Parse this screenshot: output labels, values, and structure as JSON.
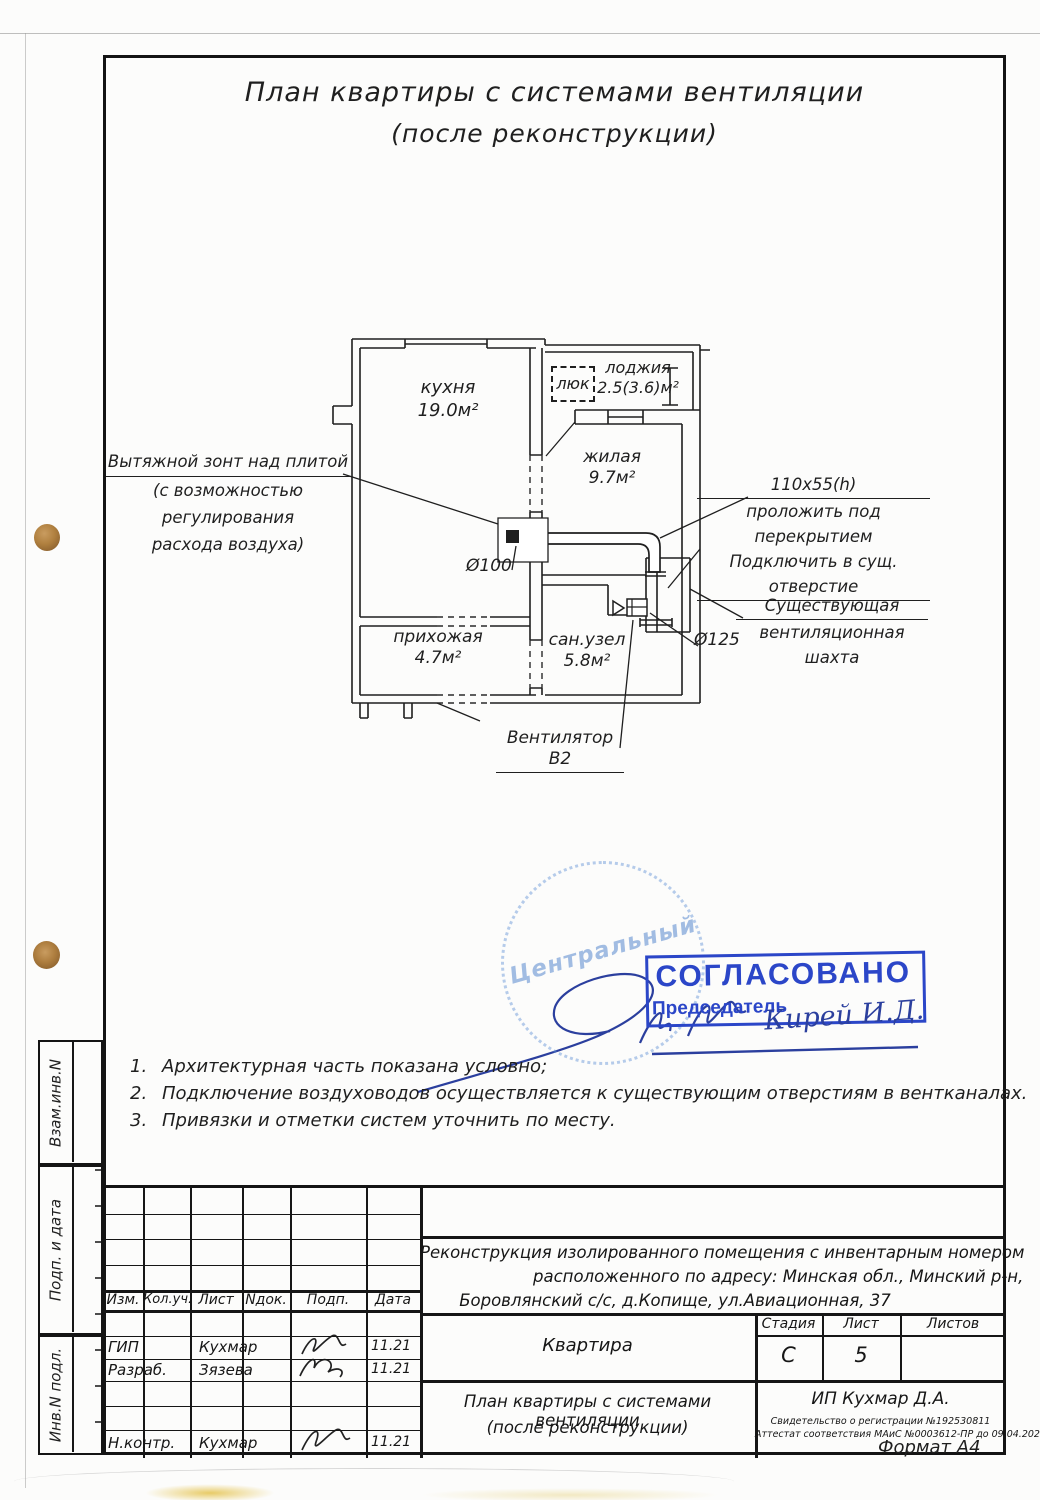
{
  "title": {
    "line1": "План квартиры с системами вентиляции",
    "line2": "(после реконструкции)"
  },
  "plan": {
    "rooms": [
      {
        "name": "кухня",
        "area": "19.0м²"
      },
      {
        "name": "лоджия",
        "area": "2.5(3.6)м²"
      },
      {
        "name": "жилая",
        "area": "9.7м²"
      },
      {
        "name": "прихожая",
        "area": "4.7м²"
      },
      {
        "name": "сан.узел",
        "area": "5.8м²"
      }
    ],
    "hatch_label": "люк",
    "d100": "Ø100",
    "d125": "Ø125",
    "fan_label": "Вентилятор В2",
    "duct_size": "110x55(h)",
    "duct_note1": "проложить под перекрытием",
    "duct_note2": "Подключить в сущ. отверстие",
    "shaft_line1": "Существующая",
    "shaft_line2": "вентиляционная шахта",
    "hood_line1": "Вытяжной зонт над плитой",
    "hood_line2": "(с возможностью регулирования",
    "hood_line3": "расхода воздуха)"
  },
  "notes": [
    {
      "num": "1.",
      "text": "Архитектурная часть показана условно;"
    },
    {
      "num": "2.",
      "text": "Подключение воздуховодов осуществляется к существующим отверстиям в вентканалах."
    },
    {
      "num": "3.",
      "text": "Привязки и отметки систем уточнить по месту."
    }
  ],
  "stamps": {
    "round_text": "Центральный",
    "approved": "СОГЛАСОВАНО",
    "chairman": "Председатель",
    "signature": "Кирей И.Д.",
    "stamp_blue": "#2b46c8",
    "signature_blue": "#2b3f9e"
  },
  "sidebar": {
    "box1": "Взам.инв.N",
    "box2": "Подп. и дата",
    "box3": "Инв.N подл."
  },
  "titleblock": {
    "col_izm": "Изм.",
    "col_kol": "Кол.уч.",
    "col_list": "Лист",
    "col_ndok": "Nдок.",
    "col_podp": "Подп.",
    "col_data": "Дата",
    "rows": [
      {
        "role": "ГИП",
        "name": "Кухмар",
        "date": "11.21"
      },
      {
        "role": "Разраб.",
        "name": "Зязева",
        "date": "11.21"
      },
      {
        "role": "Н.контр.",
        "name": "Кухмар",
        "date": "11.21"
      }
    ],
    "project_line1": "Реконструкция изолированного помещения с инвентарным номером",
    "project_line2": "расположенного по адресу: Минская обл., Минский р-н,",
    "project_line3": "Боровлянский с/с, д.Копище, ул.Авиационная, 37",
    "object_label": "Квартира",
    "stage_label": "Стадия",
    "sheet_label": "Лист",
    "sheets_label": "Листов",
    "stage_value": "С",
    "sheet_value": "5",
    "doc_line1": "План квартиры с системами вентиляции",
    "doc_line2": "(после реконструкции)",
    "company": "ИП Кухмар Д.А.",
    "cert1": "Свидетельство о регистрации №192530811",
    "cert2": "Аттестат соответствия МАиС №0003612-ПР до 09.04.2026 г"
  },
  "footer": {
    "format": "Формат А4"
  },
  "colors": {
    "ink": "#1f1f1f",
    "paper": "#fcfcfb",
    "stamp_blue": "#2b46c8",
    "punch_hole": "#b0803f"
  }
}
